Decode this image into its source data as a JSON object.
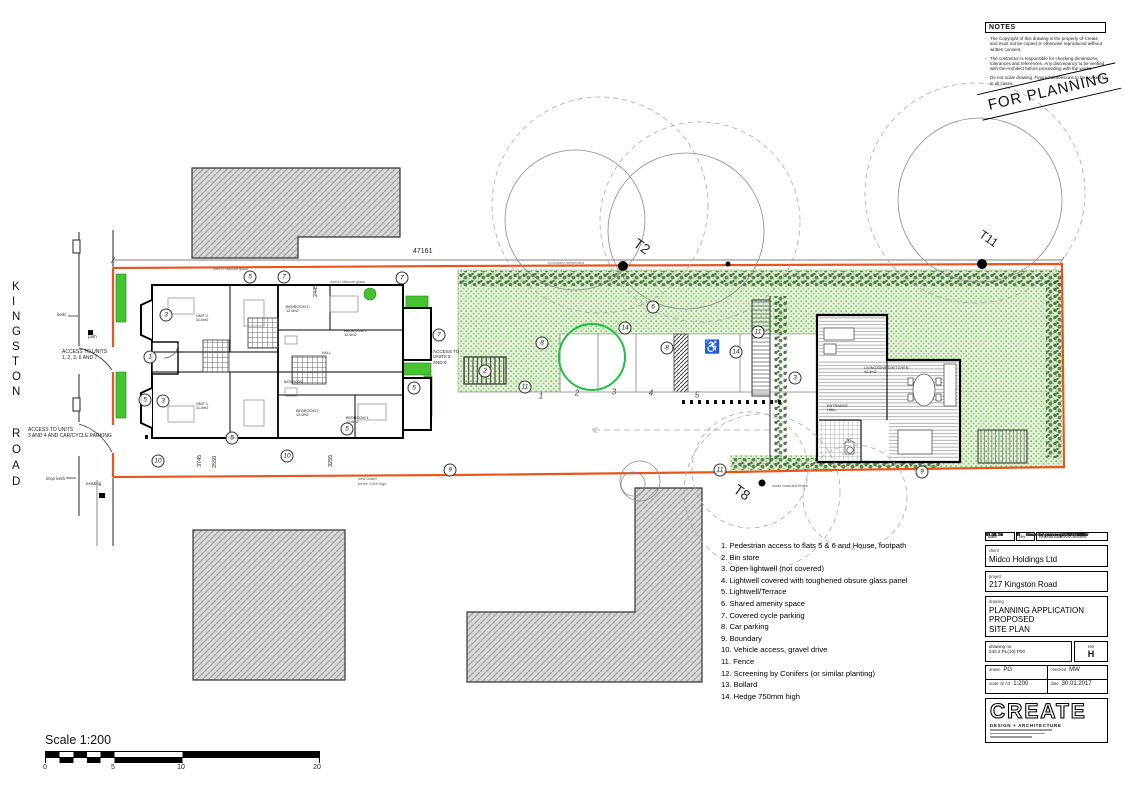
{
  "notes": {
    "title": "NOTES",
    "items": [
      "The Copyright of this drawing is the property of Create and must not be copied or otherwise reproduced without written consent.",
      "The contractor is responsible for checking dimensions, tolerances and references.  Any discrepancy to be verified with the Architect before proceeding with the works.",
      "Do not scale drawing.  Figured dimensions to be worked to in all cases."
    ]
  },
  "stamp": "FOR PLANNING",
  "road": {
    "name1": "KINGSTON",
    "name2": "ROAD"
  },
  "legend": {
    "items": [
      "1. Pedestrian access to flats 5 & 6 and House, footpath",
      "2. Bin store",
      "3. Open lightwell (not covered)",
      "4. Lightwell covered with toughened obsure glass panel",
      "5. Lightwell/Terrace",
      "6. Shared amenity space",
      "7. Covered cycle parking",
      "8. Car parking",
      "9. Boundary",
      "10. Vehicle access, gravel drive",
      "11. Fence",
      "12. Screening by Conifers (or similar planting)",
      "13. Bollard",
      "14. Hedge 750mm high"
    ]
  },
  "plan": {
    "annotations": [
      {
        "n": "1",
        "x": 150,
        "y": 357
      },
      {
        "n": "3",
        "x": 166,
        "y": 315
      },
      {
        "n": "5",
        "x": 250,
        "y": 277
      },
      {
        "n": "7",
        "x": 284,
        "y": 277
      },
      {
        "n": "7",
        "x": 402,
        "y": 278
      },
      {
        "n": "3",
        "x": 163,
        "y": 401
      },
      {
        "n": "5",
        "x": 145,
        "y": 400
      },
      {
        "n": "5",
        "x": 414,
        "y": 388
      },
      {
        "n": "7",
        "x": 439,
        "y": 335
      },
      {
        "n": "5",
        "x": 232,
        "y": 438
      },
      {
        "n": "5",
        "x": 347,
        "y": 429
      },
      {
        "n": "10",
        "x": 158,
        "y": 461
      },
      {
        "n": "10",
        "x": 287,
        "y": 456
      },
      {
        "n": "9",
        "x": 450,
        "y": 470
      },
      {
        "n": "9",
        "x": 922,
        "y": 472
      },
      {
        "n": "6",
        "x": 653,
        "y": 307
      },
      {
        "n": "8",
        "x": 542,
        "y": 343
      },
      {
        "n": "8",
        "x": 667,
        "y": 348
      },
      {
        "n": "14",
        "x": 625,
        "y": 328
      },
      {
        "n": "14",
        "x": 736,
        "y": 352
      },
      {
        "n": "11",
        "x": 758,
        "y": 332
      },
      {
        "n": "11",
        "x": 525,
        "y": 387
      },
      {
        "n": "11",
        "x": 720,
        "y": 470
      },
      {
        "n": "2",
        "x": 485,
        "y": 371
      },
      {
        "n": "3",
        "x": 795,
        "y": 378
      }
    ],
    "parking_numbers": [
      {
        "n": "1",
        "x": 541,
        "y": 396
      },
      {
        "n": "2",
        "x": 577,
        "y": 393
      },
      {
        "n": "3",
        "x": 614,
        "y": 392
      },
      {
        "n": "4",
        "x": 651,
        "y": 393
      },
      {
        "n": "5",
        "x": 697,
        "y": 395
      }
    ],
    "labels": [
      {
        "t": "47161",
        "x": 413,
        "y": 248,
        "fs": 7
      },
      {
        "t": "2445",
        "x": 313,
        "y": 297,
        "fs": 5.5,
        "rot": -90
      },
      {
        "t": "3745",
        "x": 197,
        "y": 467,
        "fs": 5.5,
        "rot": -90
      },
      {
        "t": "2550",
        "x": 212,
        "y": 468,
        "fs": 5.5,
        "rot": -90
      },
      {
        "t": "3255",
        "x": 328,
        "y": 467,
        "fs": 5.5,
        "rot": -90
      },
      {
        "t": "ACCESS TO UNITS\n1, 2, 3, 6 AND 7",
        "x": 62,
        "y": 350,
        "fs": 5
      },
      {
        "t": "ACCESS TO UNITS\n3 AND 4 AND CAR/CYCLE PARKING",
        "x": 28,
        "y": 428,
        "fs": 5
      },
      {
        "t": "ACCESS TO\nUNITS 5\nAND 6",
        "x": 433,
        "y": 349,
        "fs": 4.6
      },
      {
        "t": "kerb",
        "x": 57,
        "y": 312,
        "fs": 4.5,
        "c": "#333"
      },
      {
        "t": "path",
        "x": 88,
        "y": 334,
        "fs": 4.5,
        "c": "#333"
      },
      {
        "t": "drop kerb",
        "x": 46,
        "y": 476,
        "fs": 4.5,
        "c": "#333"
      },
      {
        "t": "existing",
        "x": 86,
        "y": 481,
        "fs": 4.5,
        "c": "#333"
      },
      {
        "t": "boundary delineated",
        "x": 548,
        "y": 261,
        "fs": 4,
        "c": "#777"
      },
      {
        "t": "wall in obscure glass",
        "x": 213,
        "y": 267,
        "fs": 3.8,
        "c": "#555"
      },
      {
        "t": "wall in obscure glass",
        "x": 330,
        "y": 280,
        "fs": 3.8,
        "c": "#555"
      },
      {
        "t": "new board\nfence 1.8m high",
        "x": 358,
        "y": 477,
        "fs": 4,
        "c": "#555"
      },
      {
        "t": "close boarded fence",
        "x": 772,
        "y": 484,
        "fs": 4,
        "c": "#555"
      },
      {
        "t": "UNIT 2\n11.0m2",
        "x": 196,
        "y": 314,
        "fs": 3.8
      },
      {
        "t": "UNIT 1\n11.0m2",
        "x": 196,
        "y": 402,
        "fs": 3.8
      },
      {
        "t": "BEDROOM 2\n12.0m2",
        "x": 286,
        "y": 305,
        "fs": 3.8
      },
      {
        "t": "BEDROOM 1\n12.6m2",
        "x": 344,
        "y": 329,
        "fs": 3.8
      },
      {
        "t": "BEDROOM 2\n12.0m2",
        "x": 296,
        "y": 409,
        "fs": 3.8
      },
      {
        "t": "BEDROOM 1\n12.6m2",
        "x": 346,
        "y": 416,
        "fs": 3.8
      },
      {
        "t": "HALL",
        "x": 322,
        "y": 351,
        "fs": 3.5
      },
      {
        "t": "BATHROOM",
        "x": 284,
        "y": 381,
        "fs": 3.3
      },
      {
        "t": "LIVING/DINING/KITCHEN\n42.4m2",
        "x": 864,
        "y": 366,
        "fs": 3.8
      },
      {
        "t": "ENTRANCE\nHALL",
        "x": 827,
        "y": 404,
        "fs": 3.8
      },
      {
        "t": "WC",
        "x": 846,
        "y": 438,
        "fs": 3.8
      },
      {
        "t": "♿",
        "x": 704,
        "y": 340,
        "fs": 13,
        "c": "#222"
      },
      {
        "t": "T2",
        "x": 640,
        "y": 235,
        "fs": 14,
        "rot": 35
      },
      {
        "t": "T11",
        "x": 984,
        "y": 228,
        "fs": 12,
        "rot": 35
      },
      {
        "t": "T8",
        "x": 740,
        "y": 481,
        "fs": 14,
        "rot": 35
      }
    ]
  },
  "title_block": {
    "revisions": [
      {
        "date": "13.05.21",
        "rev": "H",
        "desc": "Issue for planning / AP / MW"
      },
      {
        "date": "30.09.19",
        "rev": "G",
        "desc": "Issue for comments / AP / MW"
      },
      {
        "date": "08.06.18",
        "rev": "F",
        "desc": "Access Amended / NC / MW"
      },
      {
        "date": "13.04.18",
        "rev": "E",
        "desc": "Minor Amendment / NC / MW"
      },
      {
        "date": "23.01.18",
        "rev": "D",
        "desc": "Issue for planning / NC / MW"
      },
      {
        "date": "30.01.17",
        "rev": "C",
        "desc": "Issue for planning / PG / MW"
      },
      {
        "date": "10.11.16",
        "rev": "B",
        "desc": "Issue for comments / PG / MW"
      },
      {
        "date": "26.10.16",
        "rev": "A",
        "desc": "Issue for comments / PG / MW"
      }
    ],
    "rev_header": {
      "date": "date",
      "rev": "rev",
      "desc": "revision/author/checker"
    },
    "client_label": "client",
    "client": "Midco Holdings Ltd",
    "project_label": "project",
    "project": "217 Kingston Road",
    "drawing_label": "drawing",
    "drawing_lines": [
      "PLANNING APPLICATION",
      "PROPOSED",
      "SITE PLAN"
    ],
    "drawing_no_label": "drawing no",
    "drawing_no": "240 2 PL(10) P00",
    "rev_label": "rev",
    "rev": "H",
    "drawn_label": "drawn",
    "drawn": "PG",
    "checked_label": "checked",
    "checked": "MW",
    "scale_label": "scale @ A3",
    "scale": "1:200",
    "date_label": "date",
    "date": "30.01.2017",
    "logo_name": "CREATE",
    "logo_sub": "DESIGN + ARCHITECTURE"
  },
  "scale_bar": {
    "title": "Scale 1:200",
    "ticks": [
      {
        "t": "0",
        "x": 45,
        "y": 764
      },
      {
        "t": "5",
        "x": 113,
        "y": 764
      },
      {
        "t": "10",
        "x": 181,
        "y": 764
      },
      {
        "t": "20",
        "x": 317,
        "y": 764
      }
    ]
  }
}
